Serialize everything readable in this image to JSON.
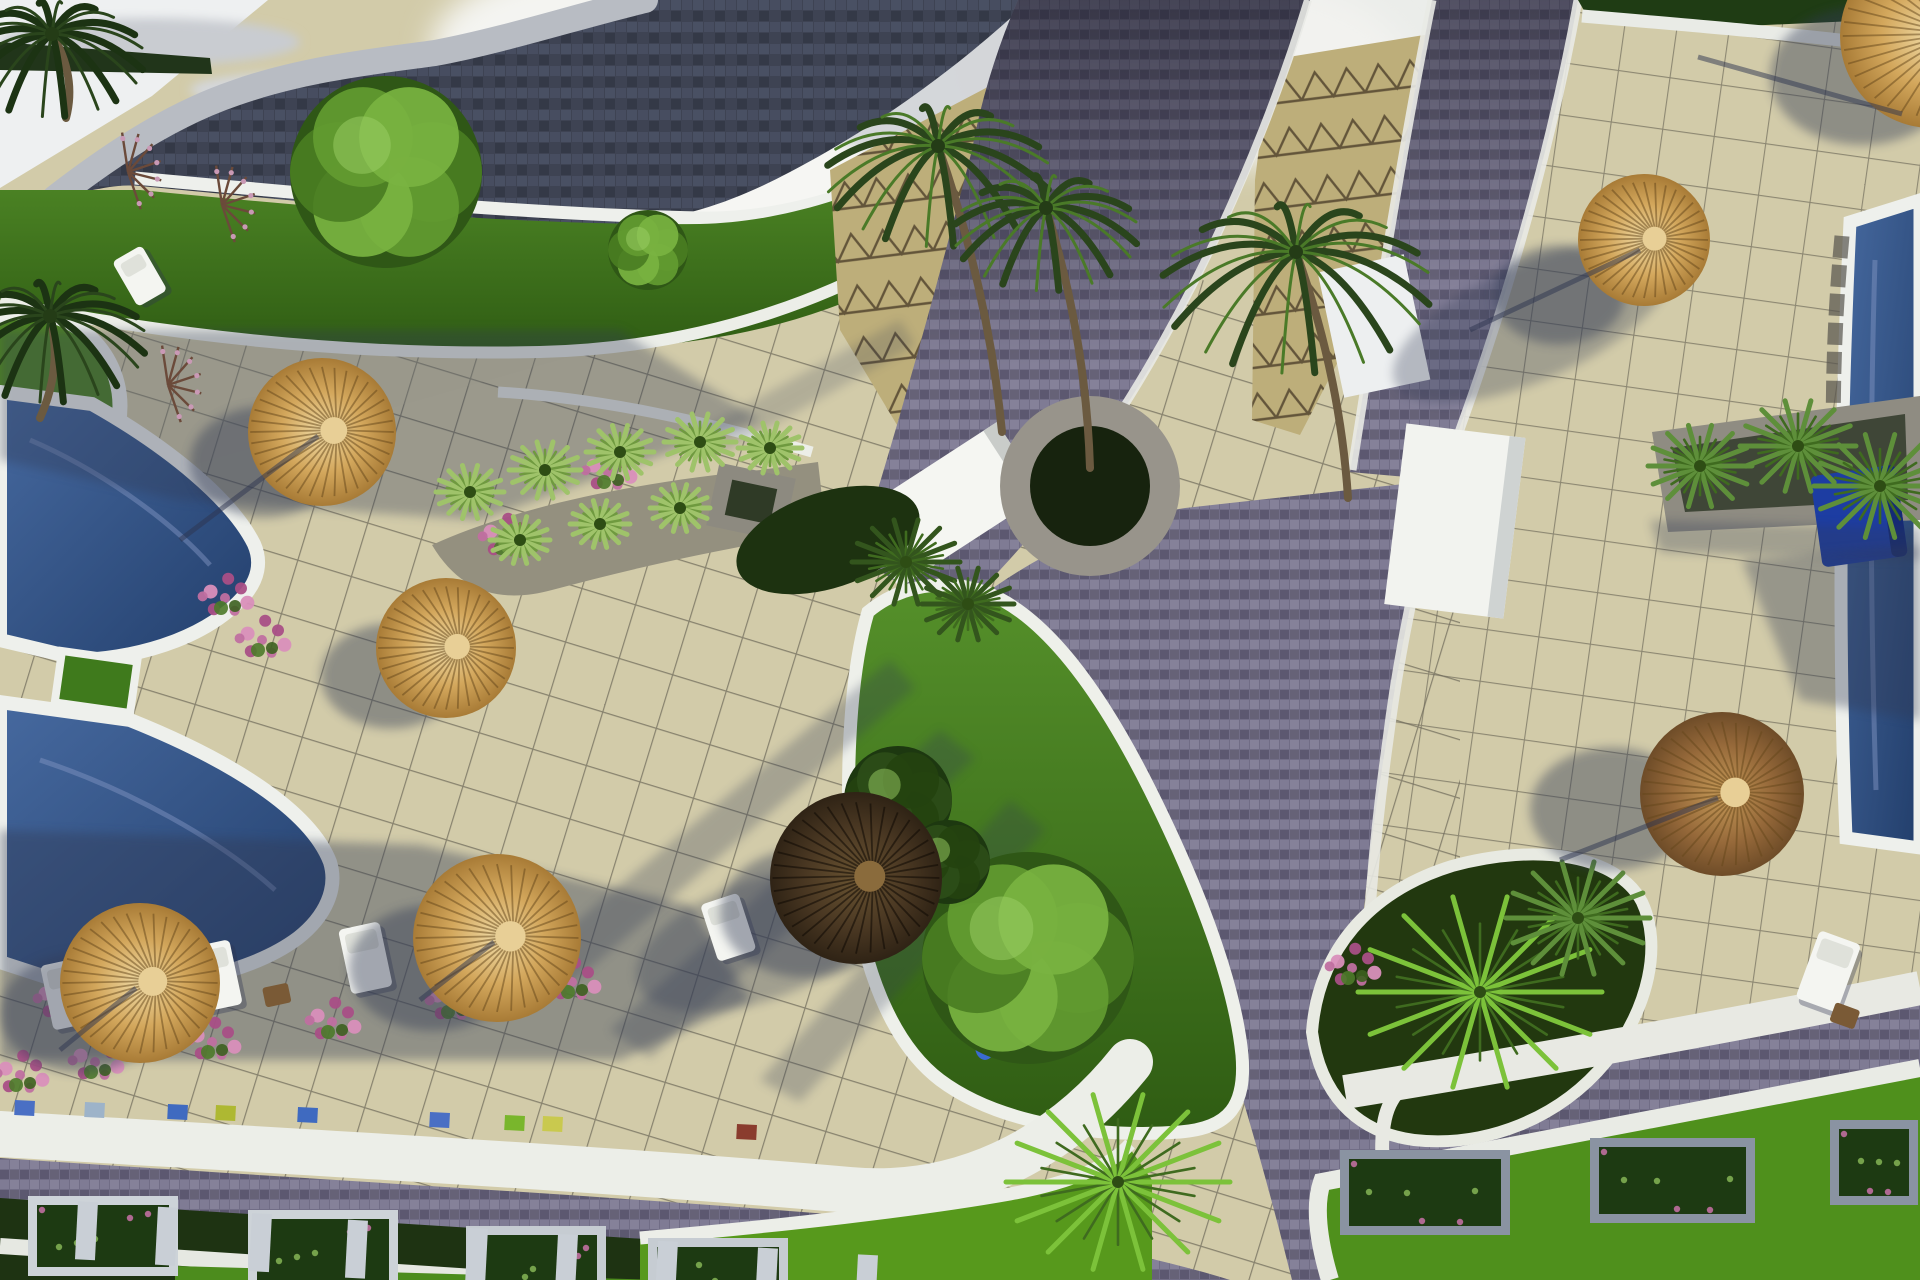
{
  "meta": {
    "title": "Resort pool terrace - aerial 3D render",
    "description": "Aerial 3D architectural rendering of a resort: tiled sun terraces with straw umbrellas and white loungers, swimming pools, palm trees, green planting islands, white curbs and dark cobblestone paths meeting at a T-junction."
  },
  "palette": {
    "paving": "#d2cba9",
    "paving_right": "#d6cfae",
    "grid_line": "#6f6b5b",
    "plaza": "#bdae7a",
    "cobble": "#716d86",
    "roof": "#3e4353",
    "white": "#eef0ec",
    "lawn": "#4e8424",
    "lawn_bright": "#57991c",
    "hedge": "#1e3312",
    "pool_light": "#4066a6",
    "pool_dark": "#24406e",
    "straw_light": "#ecd49c",
    "straw_dark": "#a87b36",
    "shadow": "#323a55",
    "navy_box": "#1d3da2",
    "pink_flower": "#c06fa0",
    "wood": "#7a5a36"
  },
  "scene": {
    "umbrellas": [
      {
        "x": 322,
        "y": 432,
        "r": 74,
        "style": "straw",
        "sdx": -58,
        "sdy": 30
      },
      {
        "x": 446,
        "y": 648,
        "r": 70,
        "style": "straw",
        "sdx": -55,
        "sdy": 28
      },
      {
        "x": 140,
        "y": 983,
        "r": 80,
        "style": "straw",
        "sdx": -60,
        "sdy": 30
      },
      {
        "x": 497,
        "y": 938,
        "r": 84,
        "style": "straw",
        "sdx": -64,
        "sdy": 30
      },
      {
        "x": 856,
        "y": 878,
        "r": 86,
        "style": "dark",
        "sdx": -50,
        "sdy": 35
      },
      {
        "x": 1644,
        "y": 240,
        "r": 66,
        "style": "straw",
        "sdx": -85,
        "sdy": 55
      },
      {
        "x": 1722,
        "y": 794,
        "r": 82,
        "style": "brown",
        "sdx": -110,
        "sdy": 15
      },
      {
        "x": 1932,
        "y": 36,
        "r": 92,
        "style": "straw",
        "sdx": -70,
        "sdy": 40
      }
    ],
    "loungers": [
      {
        "x": 40,
        "y": 966,
        "w": 42,
        "h": 66,
        "rot": -12
      },
      {
        "x": 188,
        "y": 948,
        "w": 42,
        "h": 66,
        "rot": -12
      },
      {
        "x": 338,
        "y": 930,
        "w": 42,
        "h": 66,
        "rot": -12
      },
      {
        "x": 490,
        "y": 912,
        "w": 42,
        "h": 66,
        "rot": -12
      },
      {
        "x": 1820,
        "y": 930,
        "w": 44,
        "h": 72,
        "rot": 20
      },
      {
        "x": 112,
        "y": 262,
        "w": 34,
        "h": 52,
        "rot": -30
      },
      {
        "x": 700,
        "y": 905,
        "w": 40,
        "h": 60,
        "rot": -18
      }
    ],
    "tables": [
      {
        "x": 96,
        "y": 1008,
        "rot": -12
      },
      {
        "x": 262,
        "y": 988,
        "rot": -12
      },
      {
        "x": 428,
        "y": 966,
        "rot": -12
      },
      {
        "x": 1836,
        "y": 1002,
        "rot": 20
      }
    ],
    "bins": [
      {
        "x": 15,
        "y": 1100,
        "c": "#4a6fc4"
      },
      {
        "x": 85,
        "y": 1102,
        "c": "#9db3c9"
      },
      {
        "x": 168,
        "y": 1104,
        "c": "#3f6ac0"
      },
      {
        "x": 216,
        "y": 1105,
        "c": "#aeb832"
      },
      {
        "x": 298,
        "y": 1107,
        "c": "#3f6ac0"
      },
      {
        "x": 430,
        "y": 1112,
        "c": "#4a6fc4"
      },
      {
        "x": 505,
        "y": 1115,
        "c": "#79b62c"
      },
      {
        "x": 543,
        "y": 1116,
        "c": "#c9c94e"
      },
      {
        "x": 737,
        "y": 1124,
        "c": "#8a3c2e"
      }
    ],
    "flowers": [
      {
        "x": 20,
        "y": 1075
      },
      {
        "x": 95,
        "y": 1062
      },
      {
        "x": 212,
        "y": 1042
      },
      {
        "x": 332,
        "y": 1022
      },
      {
        "x": 452,
        "y": 1002
      },
      {
        "x": 572,
        "y": 982
      },
      {
        "x": 225,
        "y": 598
      },
      {
        "x": 262,
        "y": 640
      },
      {
        "x": 505,
        "y": 538
      },
      {
        "x": 608,
        "y": 472
      },
      {
        "x": 1352,
        "y": 968
      },
      {
        "x": 60,
        "y": 1000
      }
    ],
    "hedge_posts": [
      78,
      158,
      252,
      348,
      468,
      558,
      658,
      758,
      858
    ],
    "planter_boxes": [
      {
        "x": 28,
        "y": 1196,
        "w": 150,
        "h": 80,
        "frame": "#cdd3d8"
      },
      {
        "x": 248,
        "y": 1210,
        "w": 150,
        "h": 80,
        "frame": "#cdd3d8"
      },
      {
        "x": 466,
        "y": 1226,
        "w": 140,
        "h": 76,
        "frame": "#c6ccd2"
      },
      {
        "x": 648,
        "y": 1238,
        "w": 140,
        "h": 70,
        "frame": "#c6ccd2"
      },
      {
        "x": 1340,
        "y": 1150,
        "w": 170,
        "h": 85,
        "frame": "#8a93a2"
      },
      {
        "x": 1590,
        "y": 1138,
        "w": 165,
        "h": 85,
        "frame": "#8a93a2"
      },
      {
        "x": 1830,
        "y": 1120,
        "w": 88,
        "h": 85,
        "frame": "#8a93a2"
      }
    ],
    "palms": [
      {
        "x": 938,
        "y": 146,
        "r": 112,
        "tx": 1002,
        "ty": 432,
        "dark": false
      },
      {
        "x": 1046,
        "y": 208,
        "r": 92,
        "tx": 1090,
        "ty": 468,
        "dark": false
      },
      {
        "x": 1296,
        "y": 252,
        "r": 135,
        "tx": 1348,
        "ty": 498,
        "dark": false
      },
      {
        "x": 52,
        "y": 34,
        "r": 92,
        "tx": 66,
        "ty": 118,
        "dark": true
      },
      {
        "x": 50,
        "y": 316,
        "r": 96,
        "tx": 40,
        "ty": 418,
        "dark": true
      }
    ],
    "bursts": [
      {
        "x": 1480,
        "y": 992,
        "r": 122,
        "kind": "bright"
      },
      {
        "x": 1578,
        "y": 918,
        "r": 72,
        "kind": "mid"
      },
      {
        "x": 1118,
        "y": 1182,
        "r": 112,
        "kind": "bright"
      },
      {
        "x": 1700,
        "y": 466,
        "r": 52,
        "kind": "mid"
      },
      {
        "x": 1798,
        "y": 446,
        "r": 58,
        "kind": "mid"
      },
      {
        "x": 1880,
        "y": 486,
        "r": 66,
        "kind": "mid"
      },
      {
        "x": 906,
        "y": 562,
        "r": 54,
        "kind": "dark"
      },
      {
        "x": 968,
        "y": 604,
        "r": 46,
        "kind": "dark"
      },
      {
        "x": 470,
        "y": 492,
        "r": 34,
        "kind": "grass"
      },
      {
        "x": 545,
        "y": 470,
        "r": 36,
        "kind": "grass"
      },
      {
        "x": 620,
        "y": 452,
        "r": 34,
        "kind": "grass"
      },
      {
        "x": 700,
        "y": 442,
        "r": 36,
        "kind": "grass"
      },
      {
        "x": 770,
        "y": 448,
        "r": 32,
        "kind": "grass"
      },
      {
        "x": 520,
        "y": 540,
        "r": 30,
        "kind": "grass"
      },
      {
        "x": 600,
        "y": 524,
        "r": 30,
        "kind": "grass"
      },
      {
        "x": 680,
        "y": 508,
        "r": 30,
        "kind": "grass"
      }
    ],
    "tree_blobs": [
      {
        "x": 386,
        "y": 172,
        "r": 96,
        "kind": "leafy"
      },
      {
        "x": 1028,
        "y": 958,
        "r": 106,
        "kind": "leafy"
      },
      {
        "x": 898,
        "y": 800,
        "r": 54,
        "kind": "dark"
      },
      {
        "x": 948,
        "y": 862,
        "r": 42,
        "kind": "dark"
      },
      {
        "x": 648,
        "y": 250,
        "r": 40,
        "kind": "leafy"
      }
    ],
    "twigs": [
      {
        "x": 128,
        "y": 172
      },
      {
        "x": 222,
        "y": 205
      },
      {
        "x": 168,
        "y": 385
      }
    ],
    "pole_shadows": [
      [
        1640,
        250,
        1470,
        330
      ],
      [
        318,
        436,
        180,
        540
      ],
      [
        1698,
        57,
        1902,
        114
      ],
      [
        1718,
        798,
        1560,
        860
      ],
      [
        136,
        988,
        60,
        1050
      ],
      [
        494,
        942,
        420,
        1000
      ]
    ]
  }
}
